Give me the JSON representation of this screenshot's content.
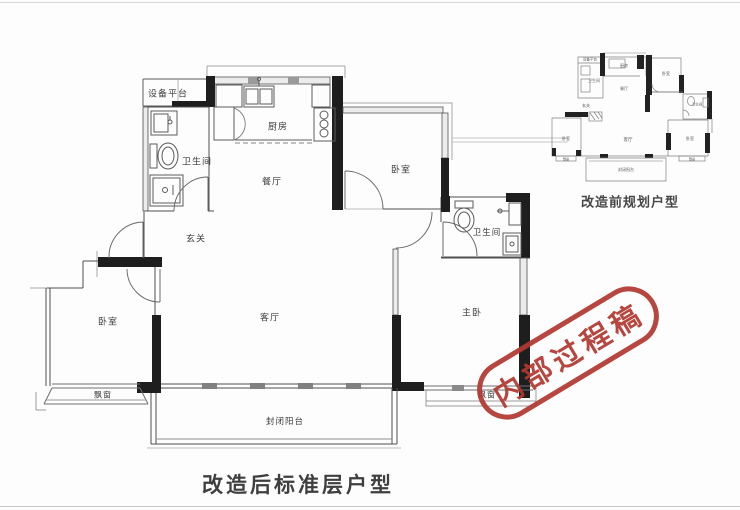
{
  "colors": {
    "stamp_red": "#b13931",
    "wall_dark": "#1e1e1e",
    "wall_thin": "#4f4f4f"
  },
  "stamp": {
    "text": "内部过程稿"
  },
  "main_plan": {
    "caption": "改造后标准层户型",
    "rooms": {
      "equipment_platform": "设备平台",
      "bathroom_left": "卫生间",
      "kitchen": "厨房",
      "dining": "餐厅",
      "entry": "玄关",
      "bedroom_top": "卧室",
      "bathroom_right": "卫生间",
      "living": "客厅",
      "master_bedroom": "主卧",
      "bedroom_left": "卧室",
      "bay_window_left": "飘窗",
      "bay_window_right": "飘窗",
      "balcony": "封闭阳台"
    }
  },
  "small_plan": {
    "caption": "改造前规划户型",
    "rooms": {
      "equipment_platform": "设备平台",
      "bathroom_left": "卫生间",
      "kitchen": "厨房",
      "dining": "餐厅",
      "bedroom_top": "卧室",
      "bathroom_right": "卫生间",
      "entry": "玄关",
      "bedroom_left": "卧室",
      "living": "客厅",
      "bedroom_right": "卧室",
      "bay_window_left": "飘窗",
      "bay_window_right": "飘窗",
      "balcony": "封闭阳台"
    }
  }
}
